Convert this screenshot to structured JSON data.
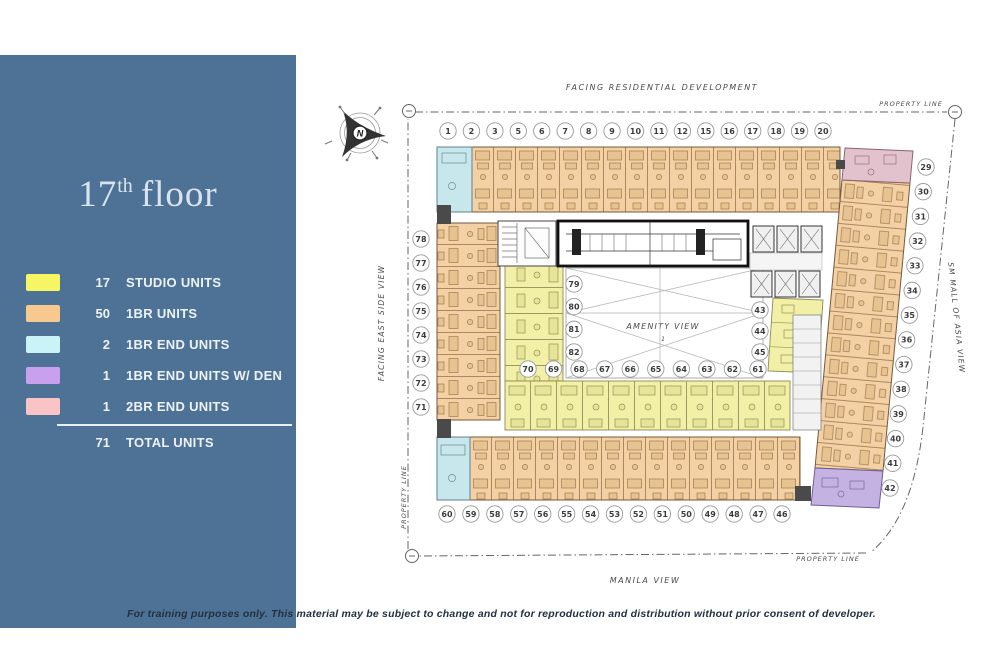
{
  "slide": {
    "title": {
      "number": "17",
      "ordinal": "th",
      "word": "floor"
    },
    "footer": "For training purposes only. This material may be subject to change and not for reproduction and distribution without prior consent of developer."
  },
  "legend": {
    "rows": [
      {
        "count": "17",
        "label": "STUDIO UNITS",
        "color": "#f6f664"
      },
      {
        "count": "50",
        "label": "1BR UNITS",
        "color": "#f8c98e"
      },
      {
        "count": "2",
        "label": "1BR END UNITS",
        "color": "#c9f3f6"
      },
      {
        "count": "1",
        "label": "1BR END UNITS W/ DEN",
        "color": "#c9a0ee"
      },
      {
        "count": "1",
        "label": "2BR END UNITS",
        "color": "#fac3c6"
      }
    ],
    "total": {
      "count": "71",
      "label": "TOTAL UNITS"
    }
  },
  "plan": {
    "labels": {
      "top": "FACING RESIDENTIAL DEVELOPMENT",
      "property_line": "PROPERTY LINE",
      "right": "SM MALL OF ASIA VIEW",
      "left": "FACING EAST SIDE VIEW",
      "bottom": "MANILA VIEW",
      "center": "AMENITY VIEW",
      "center_marker": "1",
      "compass": "N"
    },
    "unit_numbers": {
      "top": [
        "1",
        "2",
        "3",
        "5",
        "6",
        "7",
        "8",
        "9",
        "10",
        "11",
        "12",
        "15",
        "16",
        "17",
        "18",
        "19",
        "20"
      ],
      "right": [
        "29",
        "30",
        "31",
        "32",
        "33",
        "34",
        "35",
        "36",
        "37",
        "38",
        "39",
        "40",
        "41",
        "42"
      ],
      "bottom": [
        "60",
        "59",
        "58",
        "57",
        "56",
        "55",
        "54",
        "53",
        "52",
        "51",
        "50",
        "49",
        "48",
        "47",
        "46"
      ],
      "left": [
        "78",
        "77",
        "76",
        "75",
        "74",
        "73",
        "72",
        "71"
      ],
      "inner_left": [
        "79",
        "80",
        "81",
        "82"
      ],
      "inner_right": [
        "43",
        "44",
        "45"
      ],
      "inner_bottom": [
        "70",
        "69",
        "68",
        "67",
        "66",
        "65",
        "64",
        "63",
        "62",
        "61"
      ]
    },
    "colors": {
      "studio": "#f1f0a6",
      "one_br": "#f3d1a4",
      "one_br_end": "#c7e7ec",
      "one_br_end_den": "#c3b2e2",
      "two_br_end": "#e2c2cd"
    }
  }
}
